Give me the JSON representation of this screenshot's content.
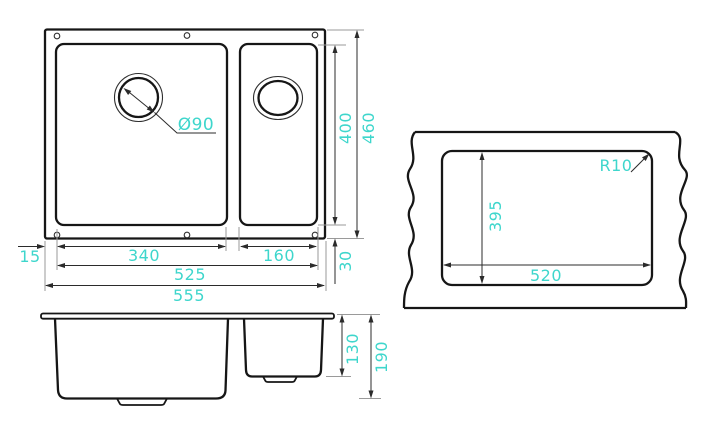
{
  "colors": {
    "accent_dimension_text": "#3ed6cc",
    "object_line": "#161616",
    "dimension_line": "#2b2b2b",
    "background": "#ffffff"
  },
  "top_view": {
    "drain_diameter": "Ø90",
    "bowl_left_width": "340",
    "bowl_right_width": "160",
    "rim_offset_left": "15",
    "inner_width": "525",
    "outer_width": "555",
    "inner_height": "400",
    "outer_height": "460",
    "rim_offset_bottom": "30"
  },
  "side_view": {
    "bowl_right_depth": "130",
    "bowl_left_depth": "190"
  },
  "cutout_view": {
    "cutout_width": "520",
    "cutout_height": "395",
    "corner_radius": "R10"
  }
}
